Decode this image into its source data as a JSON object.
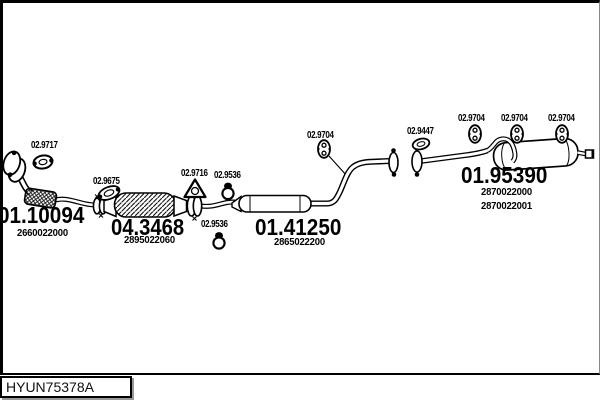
{
  "diagram": {
    "drawing_code": "HYUN75378A",
    "callouts": {
      "c9717": "02.9717",
      "c9675": "02.9675",
      "c9716": "02.9716",
      "c9536": "02.9536",
      "c9704": "02.9704",
      "c9447": "02.9447"
    },
    "parts": {
      "front_pipe": {
        "ref": "01.10094",
        "oem": "2660022000"
      },
      "catalyst": {
        "ref": "04.3468",
        "oem": "2895022060"
      },
      "middle_muffler": {
        "ref": "01.41250",
        "oem": "2865022200"
      },
      "rear_muffler": {
        "ref": "01.95390",
        "oem": "2870022000",
        "oem_alt": "2870022001"
      }
    },
    "line_color": "#000000",
    "background_color": "#ffffff"
  }
}
